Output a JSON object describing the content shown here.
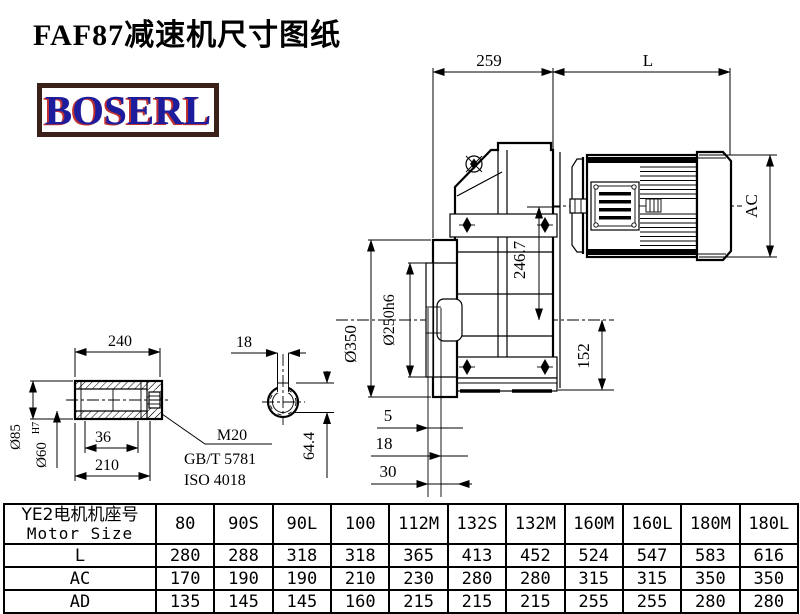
{
  "page": {
    "title": "FAF87减速机尺寸图纸",
    "logo_text": "BOSERL"
  },
  "drawing": {
    "main_view": {
      "dim_259": "259",
      "dim_L": "L",
      "dim_AC": "AC",
      "dim_flange_od": "Ø350",
      "dim_spigot_od": "Ø250h6",
      "dim_246_7": "246.7",
      "dim_152": "152",
      "dim_5": "5",
      "dim_18": "18",
      "dim_30": "30"
    },
    "shaft_view": {
      "dim_240": "240",
      "dim_18": "18",
      "dim_od": "Ø85",
      "dim_bore": "Ø60",
      "dim_bore_tol": "H7",
      "dim_36": "36",
      "dim_210": "210",
      "dim_64_4": "64.4",
      "thread_label": "M20",
      "standard_gb": "GB/T 5781",
      "standard_iso": "ISO 4018"
    }
  },
  "table": {
    "header_cn": "YE2电机机座号",
    "header_en": "Motor Size",
    "columns": [
      "80",
      "90S",
      "90L",
      "100",
      "112M",
      "132S",
      "132M",
      "160M",
      "160L",
      "180M",
      "180L"
    ],
    "rows": [
      {
        "label": "L",
        "values": [
          "280",
          "288",
          "318",
          "318",
          "365",
          "413",
          "452",
          "524",
          "547",
          "583",
          "616"
        ]
      },
      {
        "label": "AC",
        "values": [
          "170",
          "190",
          "190",
          "210",
          "230",
          "280",
          "280",
          "315",
          "315",
          "350",
          "350"
        ]
      },
      {
        "label": "AD",
        "values": [
          "135",
          "145",
          "145",
          "160",
          "215",
          "215",
          "215",
          "255",
          "255",
          "280",
          "280"
        ]
      }
    ]
  },
  "colors": {
    "line": "#000000",
    "logo_blue": "#1c1c9c",
    "logo_red": "#c03030",
    "logo_border": "#3a211a",
    "background": "#ffffff"
  }
}
